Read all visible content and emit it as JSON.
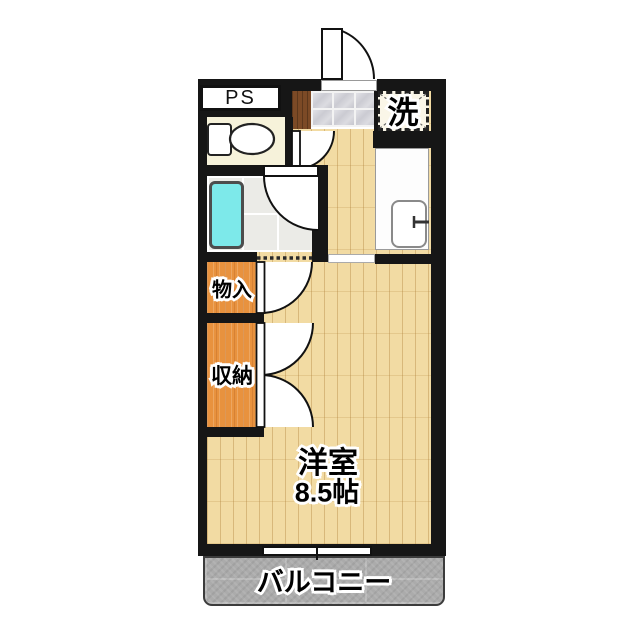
{
  "floorplan": {
    "type": "apartment-floor-plan",
    "labels": {
      "pipe_space": "PS",
      "washer": "洗",
      "storage": "物入",
      "closet": "収納",
      "room_name": "洋室",
      "room_size": "8.5帖",
      "balcony": "バルコニー"
    },
    "colors": {
      "wall": "#161616",
      "wood_floor": "#f2dba3",
      "closet_orange": "#e8923e",
      "bathtub_cyan": "#7de9ea",
      "balcony_gray": "#ababab",
      "toilet_floor": "#f6f2da",
      "entry_step_brown": "#7c4a26",
      "bath_tile": "#ebebe7",
      "entry_tile": "#cfcfd6"
    }
  }
}
